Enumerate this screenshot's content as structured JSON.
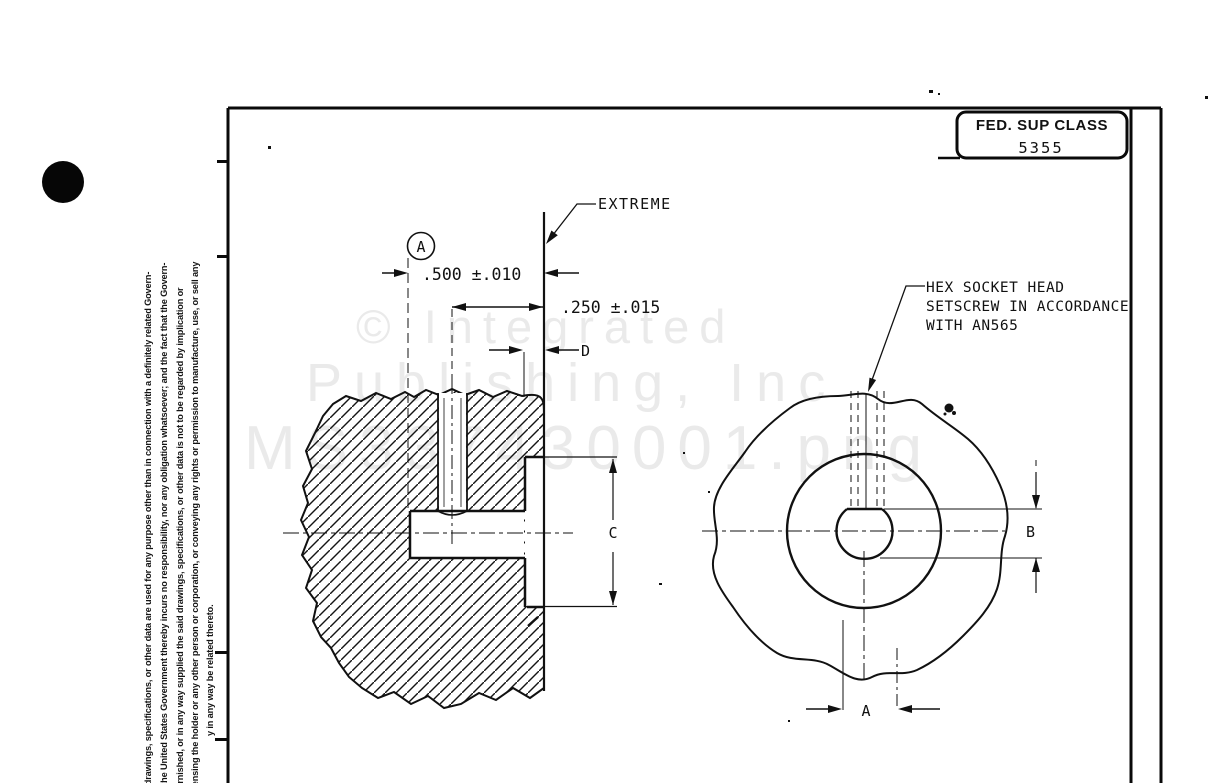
{
  "sheet": {
    "fed_sup_class": {
      "label": "FED. SUP CLASS",
      "value": "5355"
    }
  },
  "callouts": {
    "extreme": "EXTREME",
    "hex_note": [
      "HEX SOCKET HEAD",
      "SETSCREW IN ACCORDANCE",
      "WITH AN565"
    ]
  },
  "dimensions": {
    "datum_label": "A",
    "width_dim": ".500 ±.010",
    "offset_dim": ".250 ±.015",
    "dim_d": "D",
    "dim_c": "C",
    "dim_b": "B",
    "dim_a": "A"
  },
  "watermark": {
    "line1": "© Integrated",
    "line2": "Publishing, Inc",
    "line3": "MS337430001.png"
  },
  "margin_disclaimer": {
    "col1": "nt drawings, specifications, or other data are used for any purpose other than in connection with a definitely related Govern-",
    "col2": "n, the United States Government thereby incurs no responsibility, nor any obligation whatsoever; and the fact that the Govern-",
    "col3": "furnished, or in any way supplied the said drawings, specifications, or other data is not to be regarded by implication or",
    "col4": "licensing the holder or any other person or corporation, or conveying any rights or permission to manufacture, use, or sell any",
    "col5": "y in any way be related thereto."
  },
  "colors": {
    "ink": "#111111",
    "watermark": "#eaeaea",
    "paper": "#ffffff"
  }
}
